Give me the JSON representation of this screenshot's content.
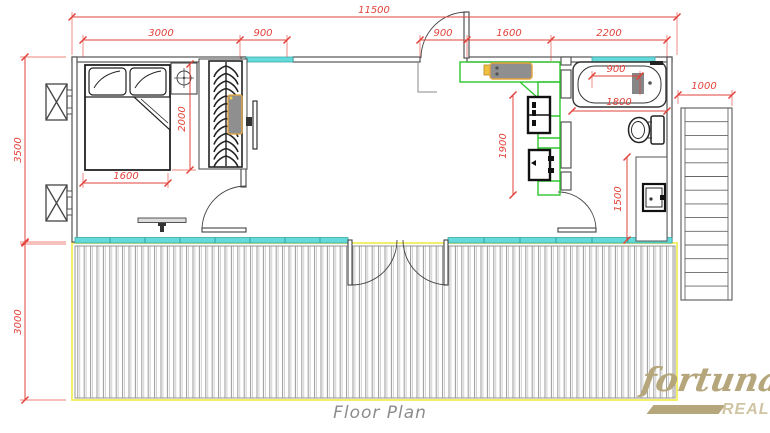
{
  "caption": "Floor Plan",
  "logo": {
    "primary": "fortuna",
    "secondary": "REAL"
  },
  "dims": {
    "overall": "11500",
    "top": [
      "3000",
      "900",
      "900",
      "1600",
      "2200"
    ],
    "building_depth": "3500",
    "deck_depth": "3000",
    "bed_width": "1600",
    "bed_length": "2000",
    "kitchen_counter": "1900",
    "bath_faucet": "900",
    "bath_length": "1800",
    "vanity": "1500",
    "stairs_width": "1000"
  },
  "colors": {
    "dimension": "#e2423b",
    "glazing": "#64dadb",
    "deck_edge": "#f3ef6a",
    "kitchen": "#2fc52f",
    "accent_orange": "#e8a33d",
    "wall": "#555555",
    "logo": "#b5a67c",
    "caption": "#8c8c8c"
  }
}
